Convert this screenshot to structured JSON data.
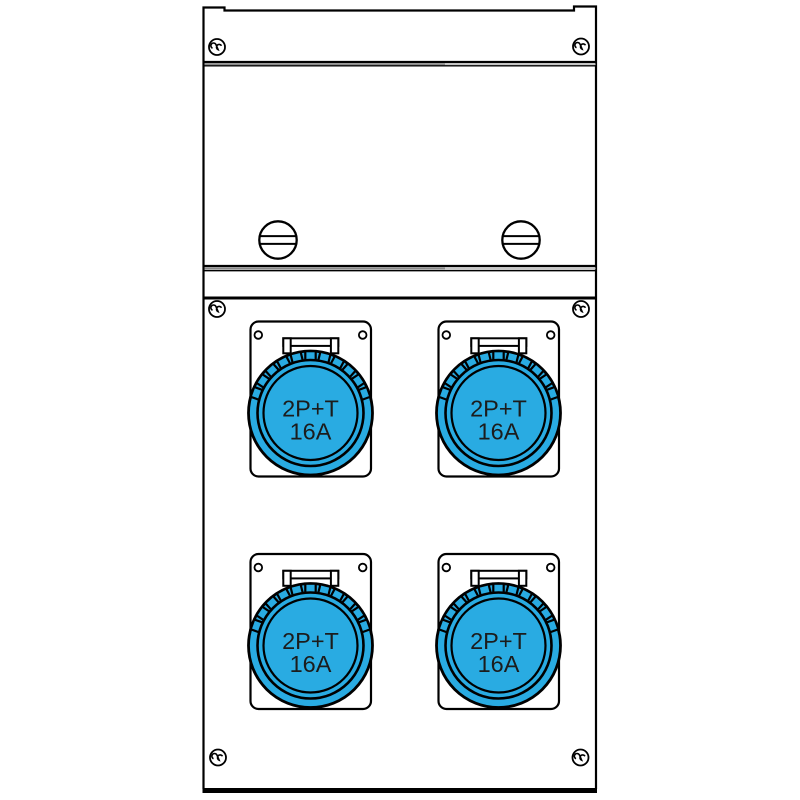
{
  "colors": {
    "socket_blue": "#29ABE2",
    "outline": "#000000",
    "background": "#ffffff",
    "divider_gray_dark": "#8a8a8a",
    "divider_gray_light": "#c6c6c6",
    "label_text": "#1c1c1c"
  },
  "sockets": [
    {
      "id": "socket-top-left",
      "label_line1": "2P+T",
      "label_line2": "16A"
    },
    {
      "id": "socket-top-right",
      "label_line1": "2P+T",
      "label_line2": "16A"
    },
    {
      "id": "socket-bottom-left",
      "label_line1": "2P+T",
      "label_line2": "16A"
    },
    {
      "id": "socket-bottom-right",
      "label_line1": "2P+T",
      "label_line2": "16A"
    }
  ],
  "icons": {
    "corner_screw": "security-screw-icon",
    "cover_screw": "slotted-screw-icon",
    "socket": "industrial-socket-2pt-16a"
  }
}
